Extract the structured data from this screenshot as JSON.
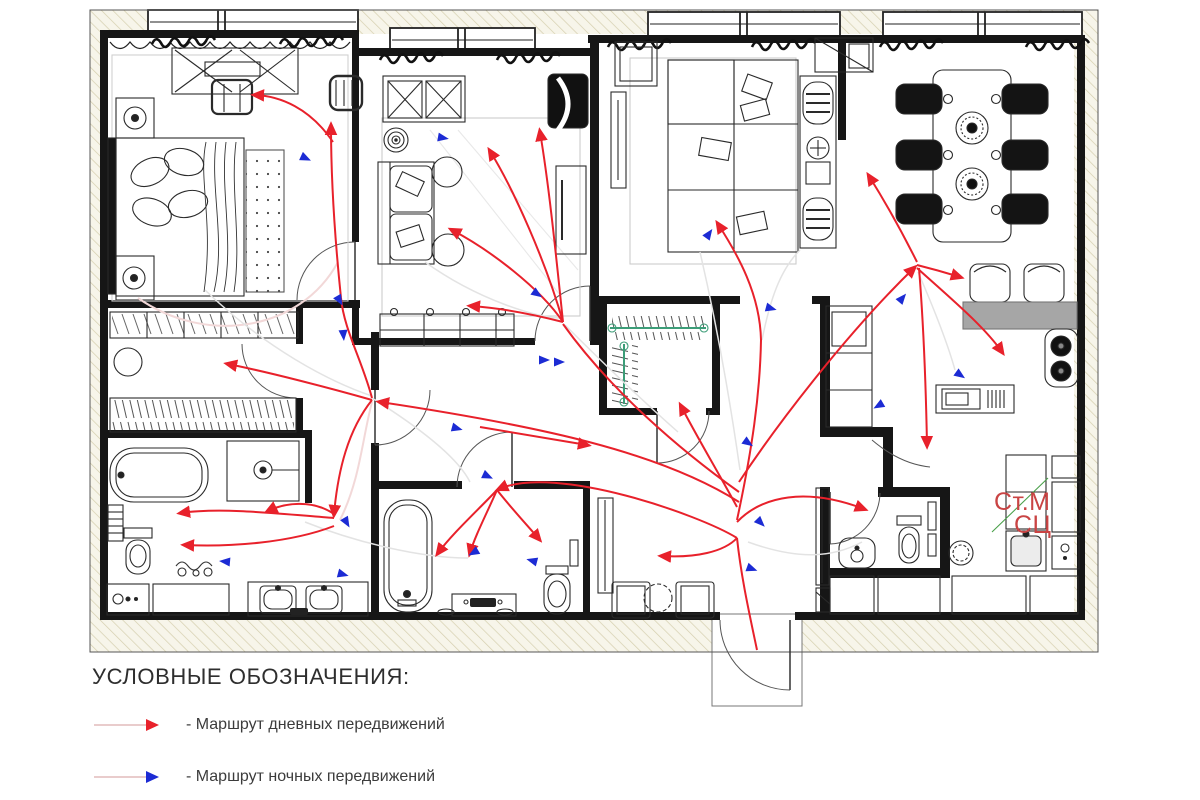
{
  "legend": {
    "title": "УСЛОВНЫЕ ОБОЗНАЧЕНИЯ:",
    "items": [
      {
        "id": "day-route",
        "label": "- Маршрут дневных передвижений",
        "color": "#e8212b"
      },
      {
        "id": "night-route",
        "label": "- Маршрут ночных передвижений",
        "color": "#1c2bd4"
      }
    ]
  },
  "plan_labels": {
    "washer": "Ст.М",
    "laundry": "СЦ",
    "color": "#c94444"
  },
  "colors": {
    "day_route": "#e8212b",
    "night_route": "#1c2bd4",
    "night_trace": "#e3e3e3",
    "pink_trace": "#f2d8d8",
    "walls": "#161616",
    "hatch_line": "#d5cfae",
    "hatch_bg": "#f7f5ea"
  },
  "routes": {
    "day": [
      {
        "d": "M757,650 C749,612 741,576 737,538",
        "head": false
      },
      {
        "d": "M737,538 C700,515 556,464 499,489",
        "head": true
      },
      {
        "d": "M497,490 C476,512 452,534 438,553",
        "head": true
      },
      {
        "d": "M497,490 C486,515 475,536 470,553",
        "head": true
      },
      {
        "d": "M497,490 C512,509 527,525 539,539",
        "head": true
      },
      {
        "d": "M737,522 C762,496 806,487 864,509",
        "head": true
      },
      {
        "d": "M737,538 C724,552 695,558 662,556",
        "head": true
      },
      {
        "d": "M739,502 C660,452 540,426 380,402",
        "head": true
      },
      {
        "d": "M372,400 C330,388 268,372 228,364",
        "head": true
      },
      {
        "d": "M372,400 C348,430 338,470 334,514",
        "head": true
      },
      {
        "d": "M334,514 C312,499 284,503 268,511",
        "head": true
      },
      {
        "d": "M334,518 C282,514 222,507 181,513",
        "head": true
      },
      {
        "d": "M334,526 C290,543 230,547 185,545",
        "head": true
      },
      {
        "d": "M372,398 C362,360 344,330 341,298",
        "head": false
      },
      {
        "d": "M341,298 C335,240 331,180 331,126",
        "head": true
      },
      {
        "d": "M333,142 C310,108 280,96 255,95",
        "head": true
      },
      {
        "d": "M739,492 C680,450 610,390 563,324",
        "head": false
      },
      {
        "d": "M563,322 C540,288 490,250 452,230",
        "head": true
      },
      {
        "d": "M563,322 C546,262 514,190 490,151",
        "head": true
      },
      {
        "d": "M563,322 C556,255 549,185 540,132",
        "head": true
      },
      {
        "d": "M563,322 C532,314 500,308 471,306",
        "head": true
      },
      {
        "d": "M480,427 C520,434 558,440 587,445",
        "head": true
      },
      {
        "d": "M737,520 C752,450 760,395 761,340 C760,294 738,255 718,224",
        "head": true
      },
      {
        "d": "M739,482 C780,420 850,330 914,268",
        "head": true
      },
      {
        "d": "M917,265 C933,269 947,273 960,277",
        "head": true
      },
      {
        "d": "M917,262 C902,232 884,200 869,176",
        "head": true
      },
      {
        "d": "M917,268 C948,296 984,326 1002,352",
        "head": true
      },
      {
        "d": "M919,268 C924,330 926,392 927,445",
        "head": true
      },
      {
        "d": "M737,507 C718,472 697,437 681,406",
        "head": true
      }
    ],
    "night_traces": [
      "M205,290 C265,348 330,382 372,396",
      "M372,398 C420,428 458,458 470,482",
      "M700,252 C718,330 730,400 740,470",
      "M425,262 C478,300 538,318 560,318",
      "M748,542 C798,560 832,558 862,542",
      "M305,522 C355,542 420,558 468,558",
      "M565,325 C602,362 644,402 678,432",
      "M918,272 C938,318 950,352 955,370",
      "M762,340 C770,300 780,270 800,250"
    ],
    "pink_traces": [
      "M138,298 C205,345 300,332 338,262",
      "M340,520 C360,480 362,440 372,402"
    ],
    "night_markers": [
      {
        "x": 301,
        "y": 156,
        "a": 25
      },
      {
        "x": 337,
        "y": 296,
        "a": 60
      },
      {
        "x": 438,
        "y": 137,
        "a": 10
      },
      {
        "x": 533,
        "y": 291,
        "a": 35
      },
      {
        "x": 539,
        "y": 360,
        "a": 0
      },
      {
        "x": 554,
        "y": 362,
        "a": 0
      },
      {
        "x": 706,
        "y": 238,
        "a": -55
      },
      {
        "x": 766,
        "y": 307,
        "a": 15
      },
      {
        "x": 744,
        "y": 440,
        "a": 35
      },
      {
        "x": 899,
        "y": 302,
        "a": -50
      },
      {
        "x": 956,
        "y": 372,
        "a": 35
      },
      {
        "x": 883,
        "y": 403,
        "a": 150
      },
      {
        "x": 452,
        "y": 427,
        "a": 15
      },
      {
        "x": 483,
        "y": 474,
        "a": 25
      },
      {
        "x": 343,
        "y": 330,
        "a": 85
      },
      {
        "x": 344,
        "y": 518,
        "a": 60
      },
      {
        "x": 338,
        "y": 573,
        "a": 15
      },
      {
        "x": 230,
        "y": 562,
        "a": 185
      },
      {
        "x": 478,
        "y": 550,
        "a": 150
      },
      {
        "x": 537,
        "y": 562,
        "a": 195
      },
      {
        "x": 757,
        "y": 519,
        "a": 45
      },
      {
        "x": 747,
        "y": 567,
        "a": 20
      }
    ]
  }
}
